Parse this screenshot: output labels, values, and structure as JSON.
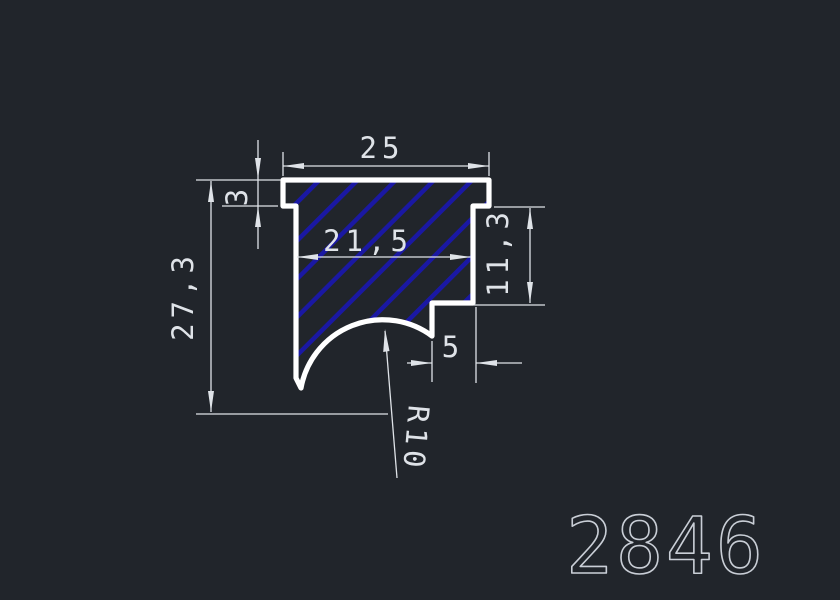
{
  "drawing": {
    "part_number": "2846",
    "dimensions": {
      "width_top": "25",
      "flange_thickness": "3",
      "height_total": "27,3",
      "width_inner": "21,5",
      "height_right": "11,3",
      "step_width": "5",
      "radius": "R10"
    },
    "colors": {
      "background": "#21252b",
      "outline": "#ffffff",
      "hatch": "#1a18a3",
      "dimension": "#dfe3e8",
      "part_number_color": "#c9ced6"
    }
  }
}
